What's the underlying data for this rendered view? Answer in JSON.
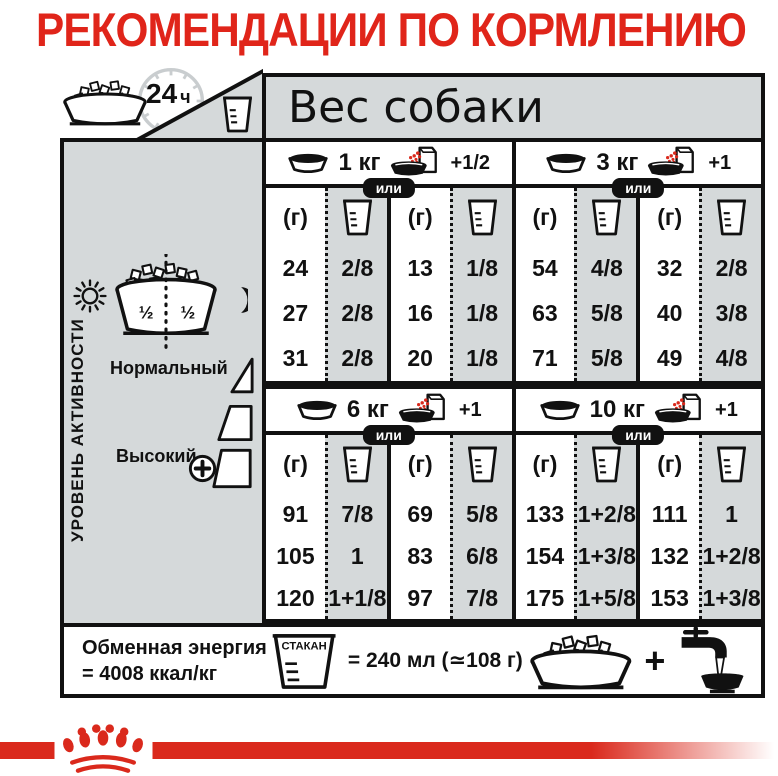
{
  "title": "РЕКОМЕНДАЦИИ ПО КОРМЛЕНИЮ",
  "header": {
    "clock_value": "24",
    "clock_unit": "ч",
    "dog_weight_label": "Вес собаки"
  },
  "sidebar": {
    "vertical_label": "УРОВЕНЬ АКТИВНОСТИ",
    "bowl_halves": [
      "½",
      "½"
    ],
    "levels": [
      {
        "label": "Нормальный"
      },
      {
        "label": "Высокий"
      }
    ]
  },
  "table": {
    "or_label": "или",
    "grams_header": "(г)",
    "groups": [
      {
        "weight": "1 кг",
        "wet_add": "+1/2",
        "dry": [
          {
            "g": "24",
            "cup": "2/8"
          },
          {
            "g": "27",
            "cup": "2/8"
          },
          {
            "g": "31",
            "cup": "2/8"
          }
        ],
        "dry_wet": [
          {
            "g": "13",
            "cup": "1/8"
          },
          {
            "g": "16",
            "cup": "1/8"
          },
          {
            "g": "20",
            "cup": "1/8"
          }
        ]
      },
      {
        "weight": "3 кг",
        "wet_add": "+1",
        "dry": [
          {
            "g": "54",
            "cup": "4/8"
          },
          {
            "g": "63",
            "cup": "5/8"
          },
          {
            "g": "71",
            "cup": "5/8"
          }
        ],
        "dry_wet": [
          {
            "g": "32",
            "cup": "2/8"
          },
          {
            "g": "40",
            "cup": "3/8"
          },
          {
            "g": "49",
            "cup": "4/8"
          }
        ]
      },
      {
        "weight": "6 кг",
        "wet_add": "+1",
        "dry": [
          {
            "g": "91",
            "cup": "7/8"
          },
          {
            "g": "105",
            "cup": "1"
          },
          {
            "g": "120",
            "cup": "1+1/8"
          }
        ],
        "dry_wet": [
          {
            "g": "69",
            "cup": "5/8"
          },
          {
            "g": "83",
            "cup": "6/8"
          },
          {
            "g": "97",
            "cup": "7/8"
          }
        ]
      },
      {
        "weight": "10 кг",
        "wet_add": "+1",
        "dry": [
          {
            "g": "133",
            "cup": "1+2/8"
          },
          {
            "g": "154",
            "cup": "1+3/8"
          },
          {
            "g": "175",
            "cup": "1+5/8"
          }
        ],
        "dry_wet": [
          {
            "g": "111",
            "cup": "1"
          },
          {
            "g": "132",
            "cup": "1+2/8"
          },
          {
            "g": "153",
            "cup": "1+3/8"
          }
        ]
      }
    ]
  },
  "footer": {
    "energy_line1": "Обменная энергия",
    "energy_line2": "= 4008 ккал/кг",
    "cup_label": "СТАКАН",
    "cup_equiv": "= 240 мл (≃108 г)",
    "plus": "+"
  },
  "colors": {
    "brand_red": "#da291c",
    "panel_gray": "#d5d9da",
    "line_black": "#111111"
  },
  "icons": {
    "kibble-bowl": "dog bowl with dry food",
    "clock-24h": "clock dial",
    "measuring-cup": "measuring cup",
    "dry-bowl": "bowl of dry food",
    "wet-food-pouch": "pouch pouring into bowl",
    "sun": "☀",
    "moon": "☾",
    "plus-circle": "⊕",
    "water-tap": "tap with water bowl",
    "crown-logo": "royal crown"
  }
}
